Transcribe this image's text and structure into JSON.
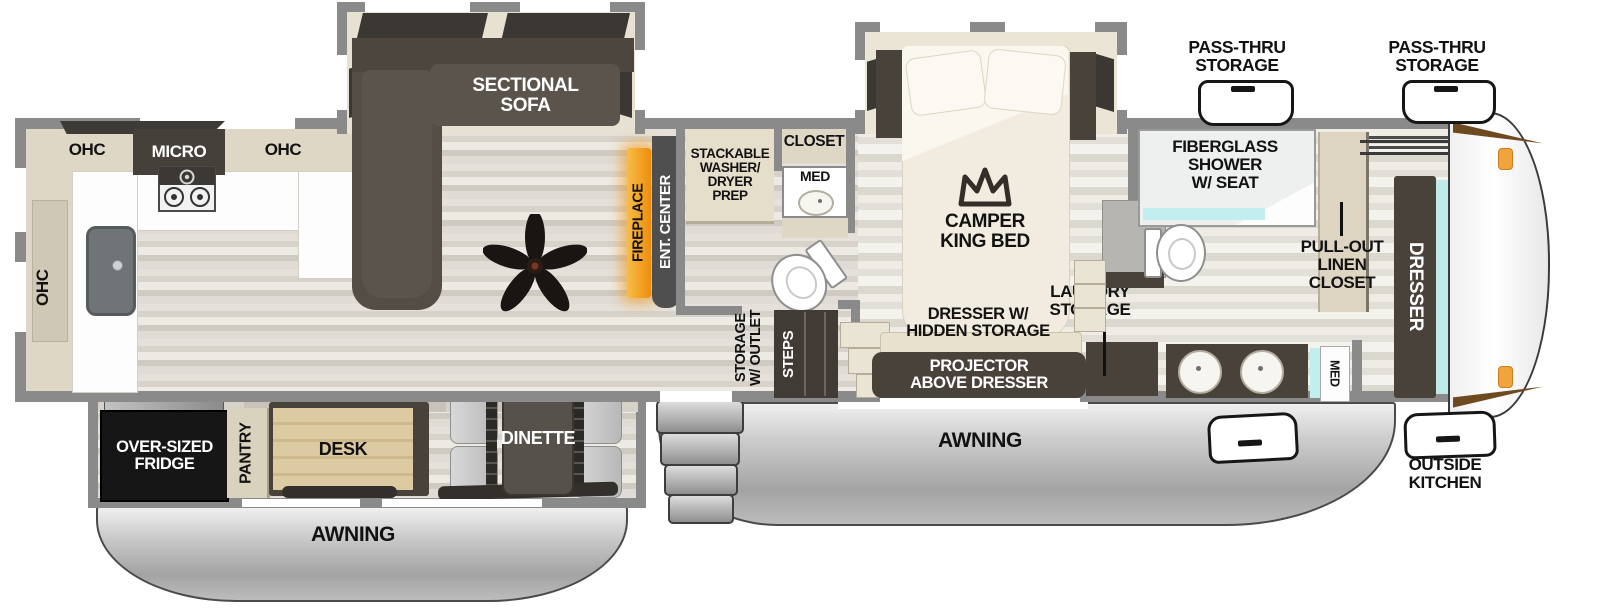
{
  "plan": {
    "kitchen": {
      "ohc_side": "OHC",
      "ohc_top_left": "OHC",
      "micro": "MICRO",
      "ohc_top_right": "OHC"
    },
    "living": {
      "sofa": "SECTIONAL\nSOFA",
      "fireplace": "FIREPLACE",
      "ent_center": "ENT. CENTER"
    },
    "mid_bath": {
      "washer_prep": "STACKABLE\nWASHER/\nDRYER\nPREP",
      "closet": "CLOSET",
      "med": "MED"
    },
    "hall": {
      "storage_outlet": "STORAGE\nW/ OUTLET",
      "steps": "STEPS"
    },
    "bedroom": {
      "bed": "CAMPER\nKING BED",
      "dresser_hidden": "DRESSER W/\nHIDDEN STORAGE",
      "projector": "PROJECTOR\nABOVE DRESSER",
      "laundry": "LAUNDRY\nSTORAGE"
    },
    "front_bath": {
      "shower": "FIBERGLASS\nSHOWER\nW/ SEAT",
      "linen": "PULL-OUT\nLINEN\nCLOSET",
      "med": "MED"
    },
    "front": {
      "dresser": "DRESSER",
      "pass_thru_left": "PASS-THRU\nSTORAGE",
      "pass_thru_right": "PASS-THRU\nSTORAGE",
      "outside_kitchen": "OUTSIDE\nKITCHEN"
    },
    "slide_lower": {
      "fridge": "OVER-SIZED\nFRIDGE",
      "pantry": "PANTRY",
      "desk": "DESK",
      "dinette": "DINETTE"
    },
    "exterior": {
      "awning_left": "AWNING",
      "awning_right": "AWNING"
    }
  },
  "colors": {
    "wall": "#8a8a8a",
    "cabinet_dark": "#49423a",
    "counter_beige": "#ded7c6",
    "fireplace_orange": "#f0941c",
    "mirror_teal": "#c0e9e9",
    "awning_silver": "#c9c9c9",
    "floor_light": "#e8e5de"
  }
}
